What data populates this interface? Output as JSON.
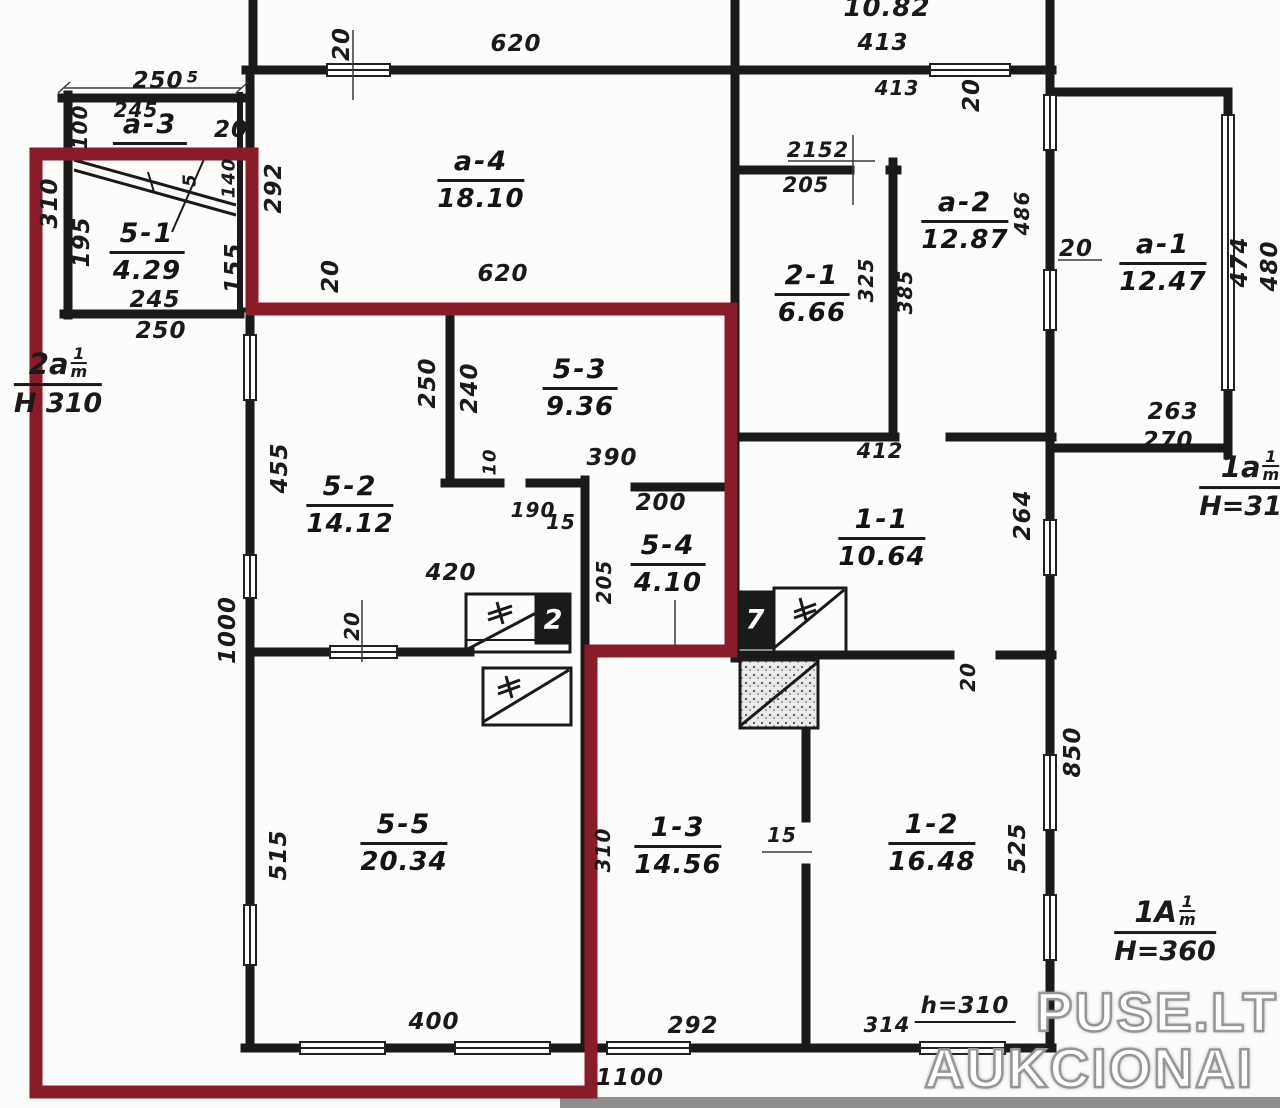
{
  "watermark": {
    "line1": "PUSE.LT",
    "line2": "AUKCIONAI"
  },
  "colors": {
    "highlight_outline": "#8a1c2a",
    "wall": "#1a1a1a",
    "watermark_stroke": "#969696"
  },
  "rooms": [
    {
      "id": "a-3",
      "area": "",
      "x": 150,
      "y": 127
    },
    {
      "id": "5-1",
      "area": "4.29",
      "x": 147,
      "y": 252
    },
    {
      "id": "a-4",
      "area": "18.10",
      "x": 481,
      "y": 180
    },
    {
      "id": "2-1",
      "area": "6.66",
      "x": 812,
      "y": 294
    },
    {
      "id": "a-2",
      "area": "12.87",
      "x": 965,
      "y": 221
    },
    {
      "id": "a-1",
      "area": "12.47",
      "x": 1163,
      "y": 263
    },
    {
      "id": "5-3",
      "area": "9.36",
      "x": 580,
      "y": 388
    },
    {
      "id": "5-2",
      "area": "14.12",
      "x": 350,
      "y": 505
    },
    {
      "id": "5-4",
      "area": "4.10",
      "x": 668,
      "y": 564
    },
    {
      "id": "1-1",
      "area": "10.64",
      "x": 882,
      "y": 538
    },
    {
      "id": "5-5",
      "area": "20.34",
      "x": 404,
      "y": 843
    },
    {
      "id": "1-3",
      "area": "14.56",
      "x": 678,
      "y": 846
    },
    {
      "id": "1-2",
      "area": "16.48",
      "x": 932,
      "y": 843
    }
  ],
  "dims": [
    {
      "t": "10.82",
      "x": 887,
      "y": 8,
      "s": 26
    },
    {
      "t": "250",
      "x": 158,
      "y": 81
    },
    {
      "t": "5",
      "x": 193,
      "y": 77,
      "s": 16
    },
    {
      "t": "245",
      "x": 136,
      "y": 110,
      "s": 20
    },
    {
      "t": "20",
      "x": 231,
      "y": 130
    },
    {
      "t": "100",
      "x": 80,
      "y": 127,
      "r": 1,
      "s": 20
    },
    {
      "t": "310",
      "x": 50,
      "y": 203,
      "r": 1
    },
    {
      "t": "195",
      "x": 82,
      "y": 242,
      "r": 1
    },
    {
      "t": "5",
      "x": 190,
      "y": 180,
      "r": 1,
      "s": 18
    },
    {
      "t": "140",
      "x": 229,
      "y": 178,
      "r": 1,
      "s": 18
    },
    {
      "t": "155",
      "x": 234,
      "y": 268,
      "r": 1
    },
    {
      "t": "245",
      "x": 155,
      "y": 300
    },
    {
      "t": "250",
      "x": 161,
      "y": 331
    },
    {
      "t": "292",
      "x": 274,
      "y": 188,
      "r": 1
    },
    {
      "t": "620",
      "x": 516,
      "y": 44
    },
    {
      "t": "20",
      "x": 342,
      "y": 44,
      "r": 1
    },
    {
      "t": "413",
      "x": 883,
      "y": 43
    },
    {
      "t": "413",
      "x": 897,
      "y": 88,
      "s": 20
    },
    {
      "t": "20",
      "x": 972,
      "y": 95,
      "r": 1
    },
    {
      "t": "2152",
      "x": 818,
      "y": 150,
      "s": 21
    },
    {
      "t": "205",
      "x": 806,
      "y": 185,
      "s": 21
    },
    {
      "t": "486",
      "x": 1022,
      "y": 213,
      "r": 1,
      "s": 20
    },
    {
      "t": "20",
      "x": 1076,
      "y": 249
    },
    {
      "t": "474",
      "x": 1240,
      "y": 262,
      "r": 1
    },
    {
      "t": "480",
      "x": 1270,
      "y": 266,
      "r": 1
    },
    {
      "t": "263",
      "x": 1173,
      "y": 412
    },
    {
      "t": "270",
      "x": 1168,
      "y": 441
    },
    {
      "t": "620",
      "x": 503,
      "y": 274
    },
    {
      "t": "20",
      "x": 331,
      "y": 276,
      "r": 1
    },
    {
      "t": "250",
      "x": 428,
      "y": 383,
      "r": 1
    },
    {
      "t": "240",
      "x": 470,
      "y": 388,
      "r": 1
    },
    {
      "t": "390",
      "x": 612,
      "y": 458
    },
    {
      "t": "10",
      "x": 490,
      "y": 462,
      "r": 1,
      "s": 18
    },
    {
      "t": "190",
      "x": 533,
      "y": 510,
      "s": 20
    },
    {
      "t": "15",
      "x": 561,
      "y": 522,
      "s": 20
    },
    {
      "t": "200",
      "x": 661,
      "y": 503
    },
    {
      "t": "205",
      "x": 604,
      "y": 582,
      "r": 1,
      "s": 20
    },
    {
      "t": "455",
      "x": 280,
      "y": 468,
      "r": 1
    },
    {
      "t": "420",
      "x": 451,
      "y": 573
    },
    {
      "t": "20",
      "x": 352,
      "y": 626,
      "r": 1,
      "s": 20
    },
    {
      "t": "412",
      "x": 880,
      "y": 451,
      "s": 21
    },
    {
      "t": "325",
      "x": 866,
      "y": 280,
      "r": 1,
      "s": 20
    },
    {
      "t": "385",
      "x": 905,
      "y": 292,
      "r": 1,
      "s": 20
    },
    {
      "t": "264",
      "x": 1023,
      "y": 515,
      "r": 1
    },
    {
      "t": "20",
      "x": 968,
      "y": 677,
      "r": 1,
      "s": 20
    },
    {
      "t": "1000",
      "x": 228,
      "y": 630,
      "r": 1
    },
    {
      "t": "515",
      "x": 279,
      "y": 855,
      "r": 1
    },
    {
      "t": "400",
      "x": 434,
      "y": 1022
    },
    {
      "t": "310",
      "x": 603,
      "y": 850,
      "r": 1,
      "s": 20
    },
    {
      "t": "292",
      "x": 693,
      "y": 1026
    },
    {
      "t": "15",
      "x": 782,
      "y": 835,
      "s": 20
    },
    {
      "t": "314",
      "x": 887,
      "y": 1025,
      "s": 21
    },
    {
      "t": "h=310",
      "x": 965,
      "y": 1008,
      "u": 1
    },
    {
      "t": "525",
      "x": 1018,
      "y": 848,
      "r": 1
    },
    {
      "t": "850",
      "x": 1073,
      "y": 752,
      "r": 1
    },
    {
      "t": "1100",
      "x": 630,
      "y": 1078
    }
  ],
  "notations": [
    {
      "pre": "2a",
      "fn": "1",
      "fd": "m",
      "h": "H 310",
      "x": 58,
      "y": 384
    },
    {
      "pre": "1a",
      "fn": "1",
      "fd": "m",
      "h": "H=310",
      "x": 1250,
      "y": 487
    },
    {
      "pre": "1A",
      "fn": "1",
      "fd": "m",
      "h": "H=360",
      "x": 1165,
      "y": 932
    }
  ],
  "stove_marks": [
    {
      "t": "2",
      "x": 553,
      "y": 620
    },
    {
      "t": "7",
      "x": 755,
      "y": 620
    }
  ]
}
